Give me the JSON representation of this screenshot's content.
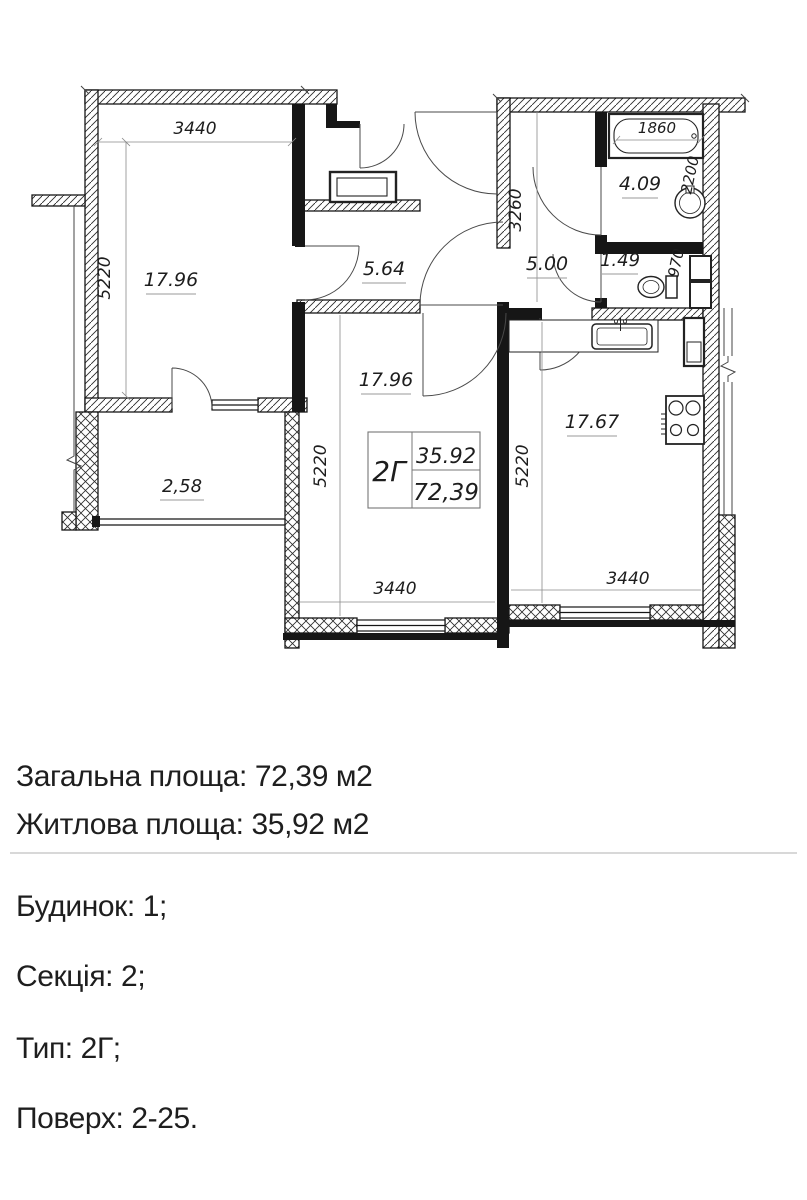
{
  "plan": {
    "rooms": {
      "bedroom": "17.96",
      "living": "17.96",
      "kitchen": "17.67",
      "hall": "5.64",
      "corridor": "5.00",
      "bathroom": "4.09",
      "wc": "1.49",
      "balcony": "2,58"
    },
    "dims": {
      "bedroom_w": "3440",
      "bedroom_h": "5220",
      "living_w": "3440",
      "living_h": "5220",
      "kitchen_w": "3440",
      "kitchen_h": "5220",
      "corridor_h": "3260",
      "bathtub_w": "1860",
      "bath_h": "2200",
      "wc_h": "970"
    },
    "stamp": {
      "type": "2Г",
      "living_total": "35.92",
      "total": "72,39"
    },
    "colors": {
      "ink": "#1d1d1d",
      "wall": "#161616",
      "accent_red": "#9b241f",
      "dim_line": "#8a8a8a"
    }
  },
  "info": {
    "total_area": "Загальна площа: 72,39 м2",
    "living_area": "Житлова площа: 35,92 м2",
    "building": "Будинок: 1;",
    "section": "Секція: 2;",
    "type": "Тип: 2Г;",
    "floors": "Поверх: 2-25."
  }
}
